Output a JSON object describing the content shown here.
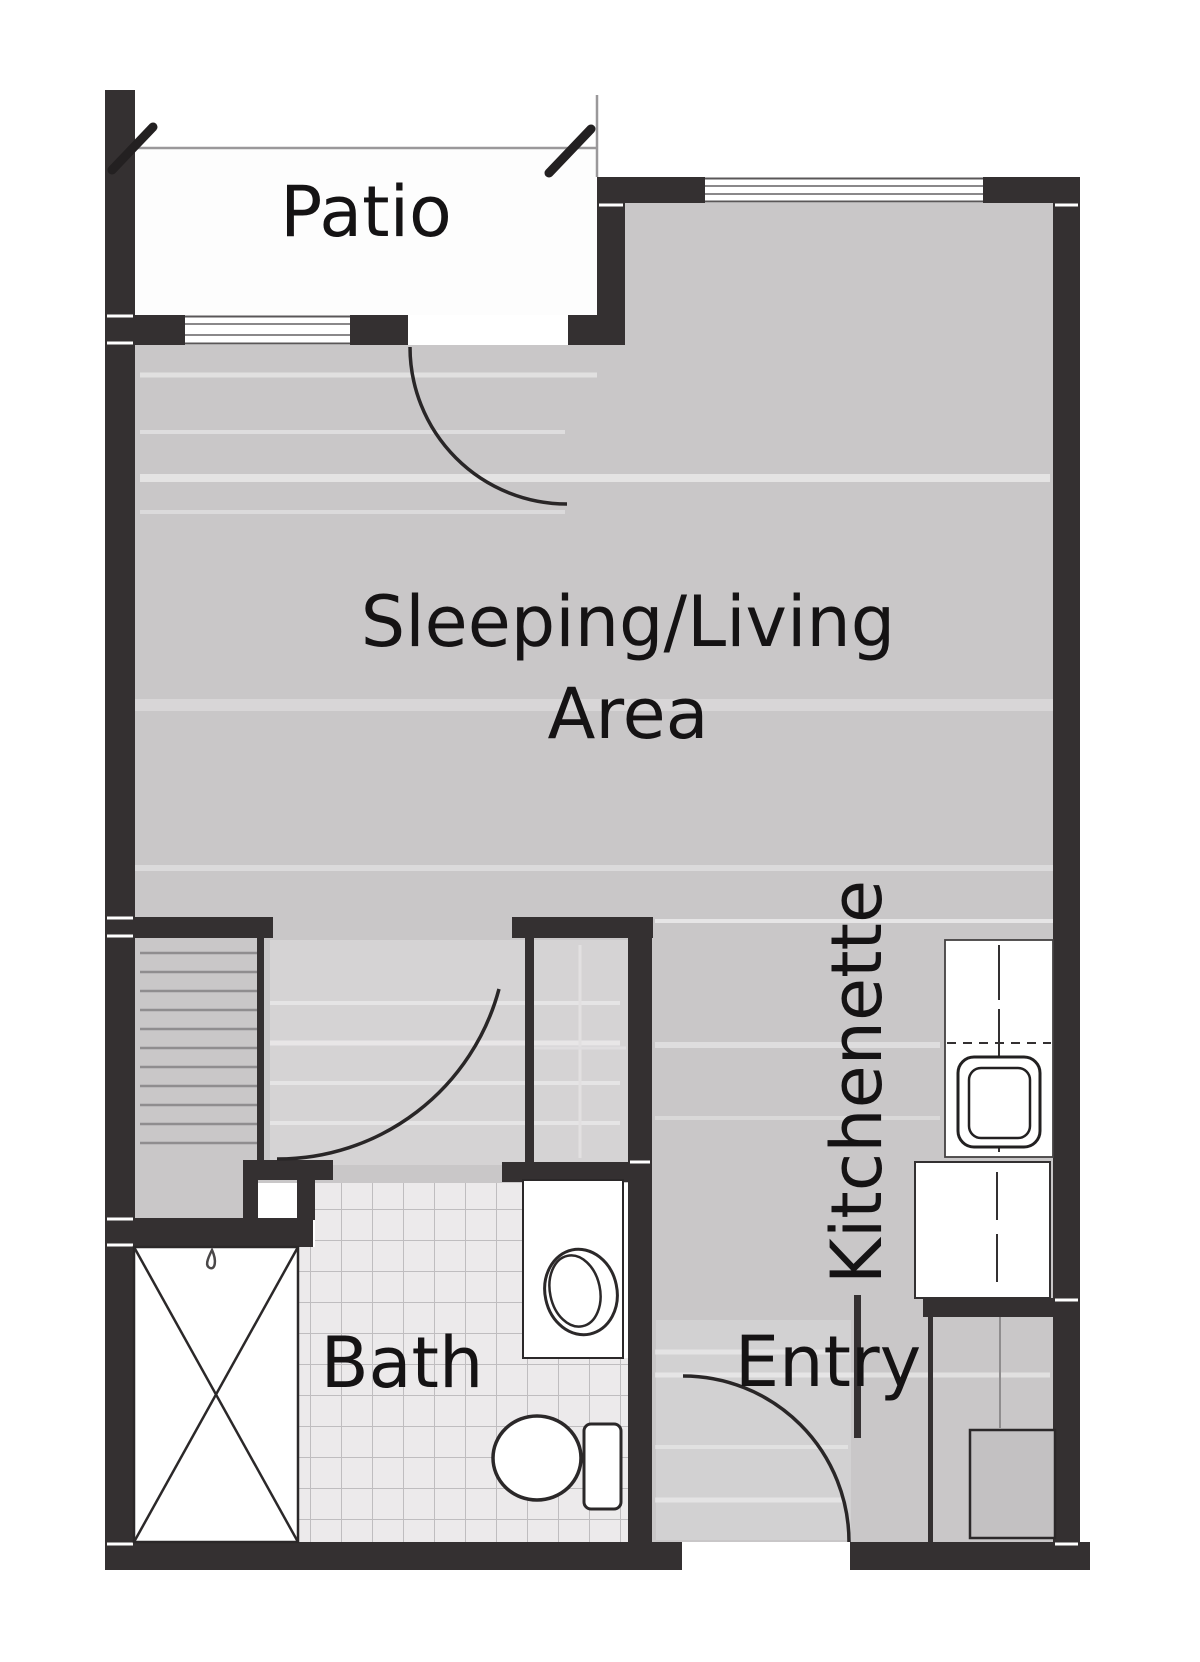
{
  "labels": {
    "patio": "Patio",
    "sleeping_living_line1": "Sleeping/Living",
    "sleeping_living_line2": "Area",
    "kitchenette": "Kitchenette",
    "bath": "Bath",
    "entry": "Entry"
  },
  "colors": {
    "wall": "#343031",
    "floor": "#c9c7c8",
    "tile": "#eceaeb",
    "tile_grid": "#bfbdbf",
    "patio_floor": "#fdfdfd",
    "fixture_fill": "#ffffff",
    "fixture_outline": "#2b2829",
    "appliance_fill": "#c3c1c2",
    "thin_line": "#9a989a",
    "label_text": "#151314",
    "background": "#ffffff"
  }
}
